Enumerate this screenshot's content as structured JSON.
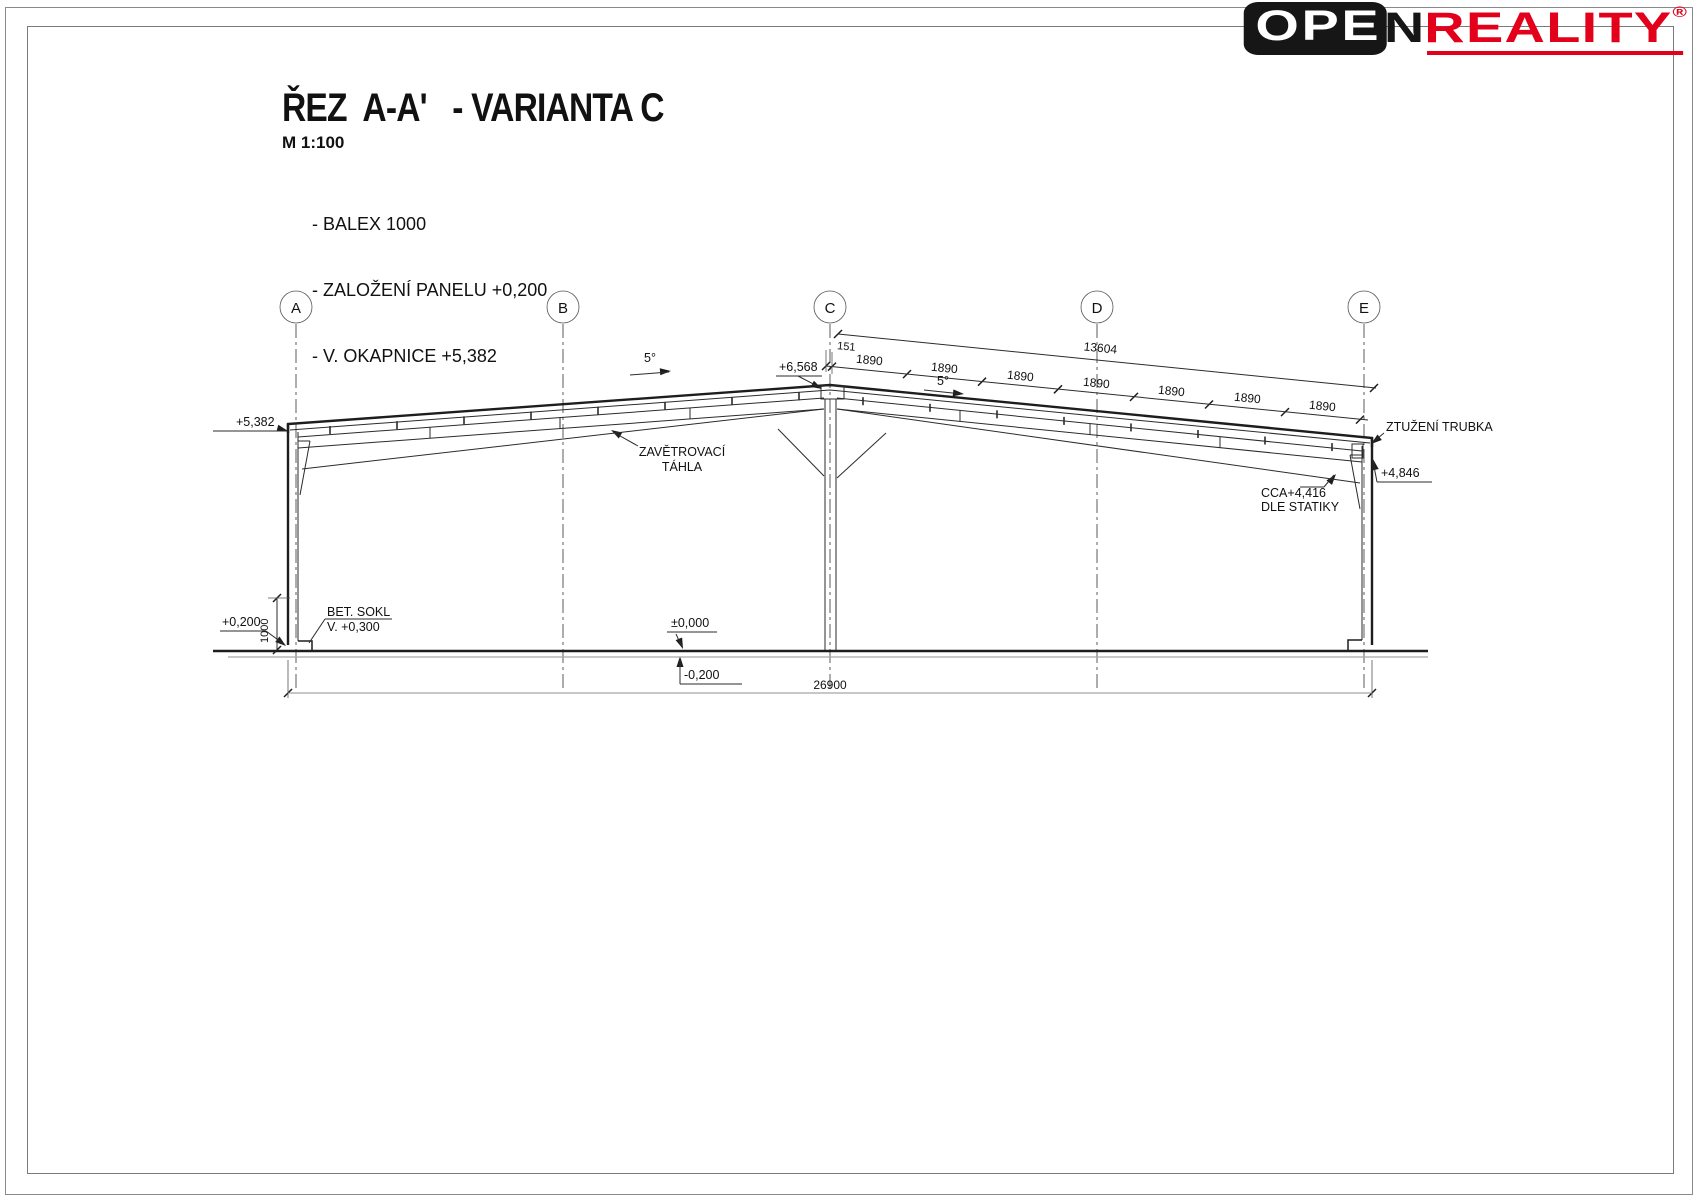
{
  "logo": {
    "box_text": "OPE",
    "n_text": "N",
    "brand_text": "REALITY",
    "reg_mark": "®",
    "brand_color": "#e2001a"
  },
  "title": {
    "main": "ŘEZ  A-A'   - VARIANTA C",
    "scale": "M 1:100",
    "notes": [
      "- BALEX 1000",
      "- ZALOŽENÍ PANELU +0,200",
      "- V. OKAPNICE +5,382"
    ]
  },
  "grid": {
    "labels": [
      "A",
      "B",
      "C",
      "D",
      "E"
    ]
  },
  "dims": {
    "overall_roof": "13604",
    "first_segment": "151",
    "roof_segments": [
      "1890",
      "1890",
      "1890",
      "1890",
      "1890",
      "1890",
      "1890"
    ],
    "slope_left": "5°",
    "slope_right": "5°",
    "ridge_level": "+6,568",
    "eave_left_level": "+5,382",
    "eave_right_level": "+4,846",
    "overall_width": "26900",
    "plinth_height": "1000",
    "floor_level": "±0,000",
    "foundation_level": "-0,200",
    "base_level": "+0,200"
  },
  "labels": {
    "bracing_line1": "ZAVĚTROVACÍ",
    "bracing_line2": "TÁHLA",
    "tube": "ZTUŽENÍ TRUBKA",
    "haunch_line1": "CCA+4,416",
    "haunch_line2": "DLE STATIKY",
    "plinth_line1": "BET. SOKL",
    "plinth_line2": "V. +0,300"
  }
}
